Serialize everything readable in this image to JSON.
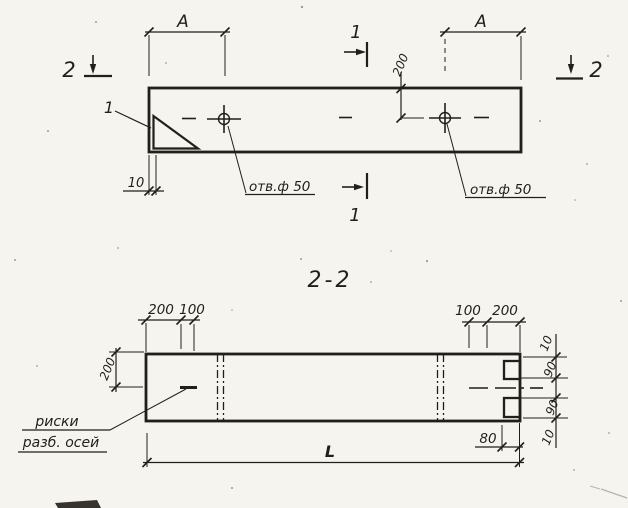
{
  "sheet": {
    "ink_color": "#211f1b",
    "paper_color": "#f5f4ee"
  },
  "plan_view": {
    "dim_a_left": "A",
    "dim_a_right": "A",
    "section1_top_label": "1",
    "section1_bottom_label": "1",
    "section2_left_label": "2",
    "section2_right_label": "2",
    "corner_detail_callout": "1",
    "dim_hole_offset": "200",
    "hole_left_label": "отв.ф 50",
    "hole_right_label": "отв.ф 50",
    "dim_wall_thickness": "10"
  },
  "section_view": {
    "title": "2-2",
    "top_left_dims": [
      "200",
      "100"
    ],
    "top_right_dims": [
      "100",
      "200"
    ],
    "dim_axis_offset": "200",
    "right_edge_dims": [
      "10",
      "90",
      "90",
      "10"
    ],
    "dim_groove": "80",
    "dim_length": "L",
    "axis_note_line1": "риски",
    "axis_note_line2": "разб. осей"
  }
}
